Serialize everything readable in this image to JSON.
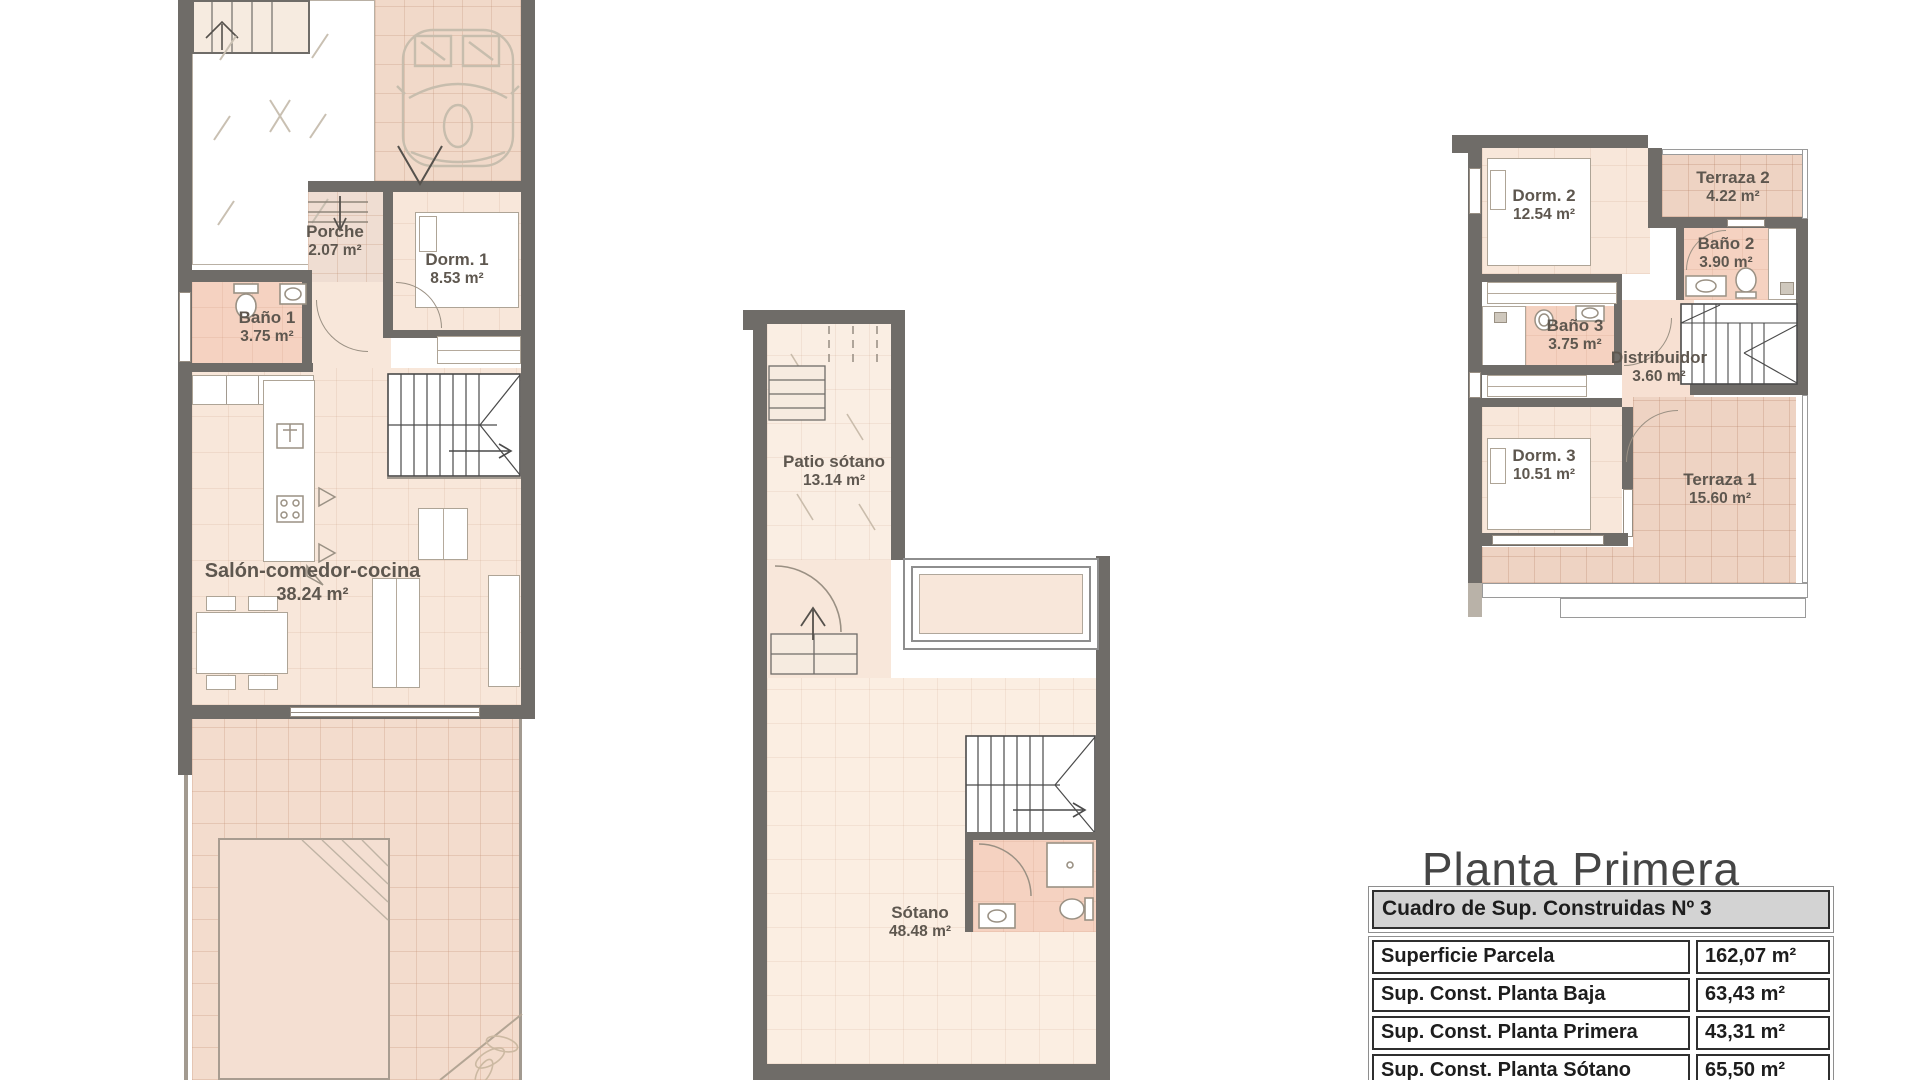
{
  "plans": {
    "ground": {
      "rooms": [
        {
          "name": "Porche",
          "area": "2.07 m²"
        },
        {
          "name": "Dorm. 1",
          "area": "8.53 m²"
        },
        {
          "name": "Baño 1",
          "area": "3.75 m²"
        },
        {
          "name": "Salón-comedor-cocina",
          "area": "38.24 m²"
        }
      ]
    },
    "basement": {
      "rooms": [
        {
          "name": "Patio sótano",
          "area": "13.14 m²"
        },
        {
          "name": "Sótano",
          "area": "48.48 m²"
        }
      ]
    },
    "first": {
      "title": "Planta Primera",
      "rooms": [
        {
          "name": "Dorm. 2",
          "area": "12.54 m²"
        },
        {
          "name": "Terraza 2",
          "area": "4.22 m²"
        },
        {
          "name": "Baño 2",
          "area": "3.90 m²"
        },
        {
          "name": "Baño 3",
          "area": "3.75 m²"
        },
        {
          "name": "Distribuidor",
          "area": "3.60 m²"
        },
        {
          "name": "Dorm. 3",
          "area": "10.51 m²"
        },
        {
          "name": "Terraza 1",
          "area": "15.60 m²"
        }
      ]
    }
  },
  "surface_table": {
    "header": "Cuadro de Sup. Construidas Nº 3",
    "rows": [
      {
        "label": "Superficie Parcela",
        "value": "162,07 m²"
      },
      {
        "label": "Sup. Const. Planta Baja",
        "value": "63,43 m²"
      },
      {
        "label": "Sup. Const. Planta Primera",
        "value": "43,31 m²"
      },
      {
        "label": "Sup. Const. Planta Sótano",
        "value": "65,50 m²"
      }
    ]
  },
  "colors": {
    "wall": "#6f6c68",
    "room_fill": "#f8e7da",
    "bath_fill": "#f5d2c1",
    "tile_fill": "#f1d9c9",
    "label_text": "#5e574f"
  }
}
